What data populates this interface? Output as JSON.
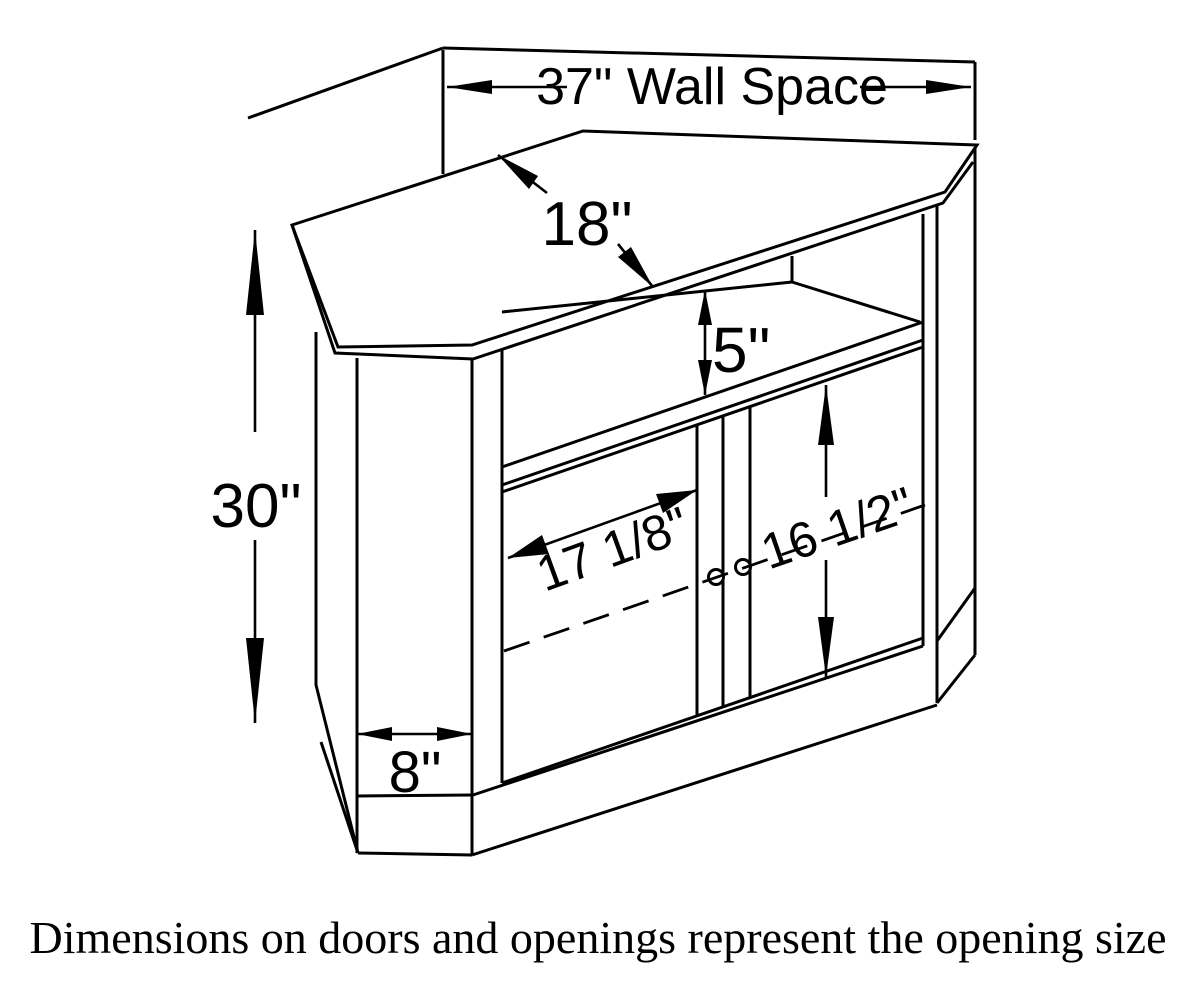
{
  "diagram": {
    "title": "corner tv stand dimensioned line drawing",
    "dimensions": {
      "wall_space": "37\" Wall Space",
      "top_depth": "18\"",
      "shelf_opening_height": "5\"",
      "overall_height": "30\"",
      "door_opening_width": "17 1/8\"",
      "door_opening_height": "16 1/2\"",
      "side_panel_width": "8\""
    },
    "caption": "Dimensions on doors and openings represent the opening size",
    "colors": {
      "line": "#000000",
      "background": "#ffffff"
    }
  }
}
